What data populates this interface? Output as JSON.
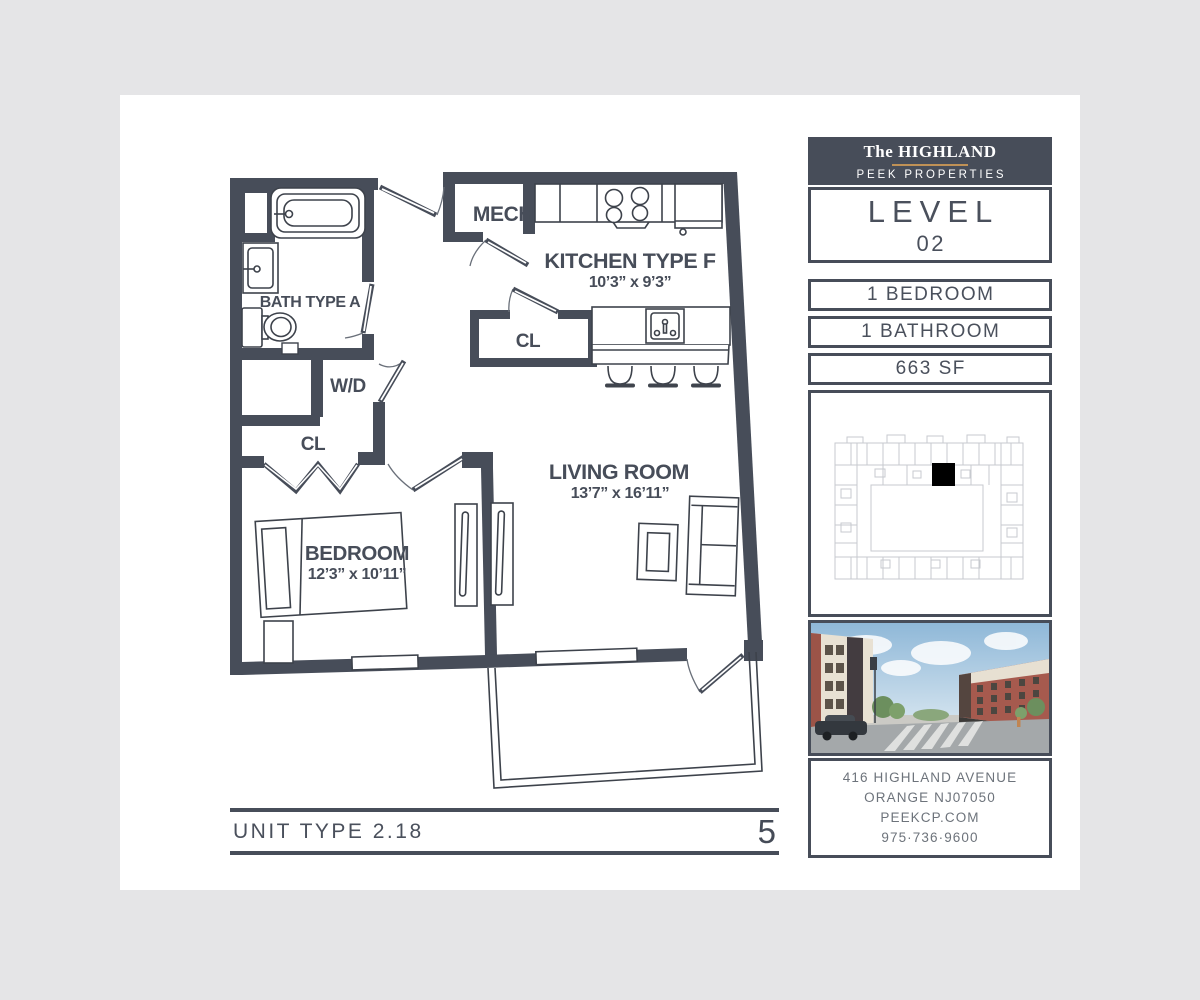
{
  "page": {
    "background": "#e5e5e7",
    "sheet_bg": "#ffffff"
  },
  "colors": {
    "wall": "#474d59",
    "accent_gold": "#bf9156",
    "text": "#4a505c",
    "muted_text": "#6d737b",
    "keyplan_stroke": "#c7cacf",
    "unit_marker": "#000000"
  },
  "floorplan": {
    "unit_label": "UNIT TYPE 2.18",
    "sheet_number": "5",
    "labels": {
      "bath": "BATH TYPE A",
      "mech": "MECH",
      "kitchen": "KITCHEN TYPE F",
      "kitchen_dims": "10’3” x 9’3”",
      "closet_kitchen": "CL",
      "washer_dryer": "W/D",
      "closet_hall": "CL",
      "bedroom": "BEDROOM",
      "bedroom_dims": "12’3” x 10’11”",
      "living": "LIVING ROOM",
      "living_dims": "13’7” x 16’11”"
    }
  },
  "sidebar": {
    "brand": {
      "prefix": "The",
      "name": "HIGHLAND",
      "company": "PEEK PROPERTIES"
    },
    "level": {
      "label": "LEVEL",
      "number": "02"
    },
    "specs": [
      "1 BEDROOM",
      "1 BATHROOM",
      "663 SF"
    ],
    "contact": {
      "address1": "416 HIGHLAND AVENUE",
      "address2": "ORANGE NJ07050",
      "website": "PEEKCP.COM",
      "phone": "975·736·9600"
    }
  }
}
